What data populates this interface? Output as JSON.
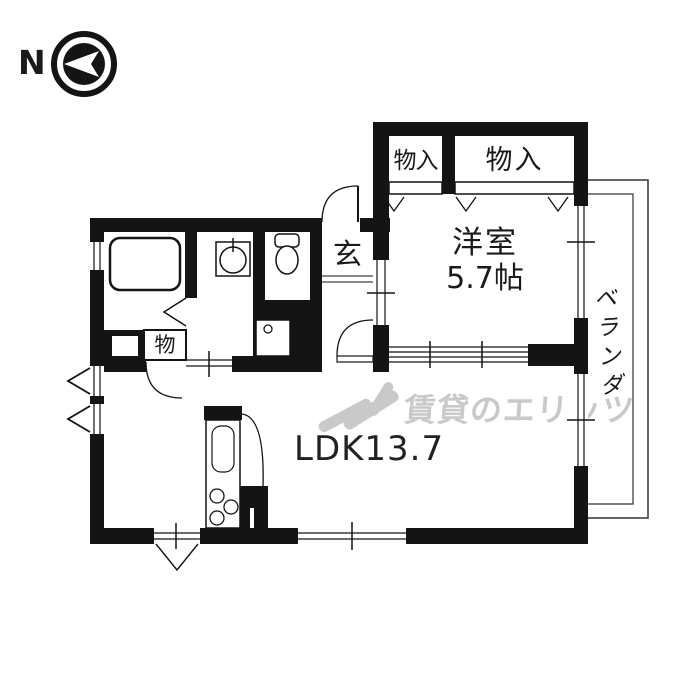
{
  "compass": {
    "label": "N"
  },
  "floorplan": {
    "closet_top_left": {
      "label": "物入"
    },
    "closet_top_right": {
      "label": "物入"
    },
    "western_room": {
      "name": "洋室",
      "size": "5.7帖"
    },
    "entrance": {
      "label": "玄"
    },
    "storage_closet": {
      "label": "物"
    },
    "ldk": {
      "label": "LDK13.7"
    },
    "veranda": {
      "label": "ベランダ"
    }
  },
  "watermark": {
    "text": "賃貸のエリッツ"
  },
  "colors": {
    "wall": "#141414",
    "thin_line": "#333333",
    "watermark": "#c9c9c9",
    "background": "#ffffff"
  }
}
